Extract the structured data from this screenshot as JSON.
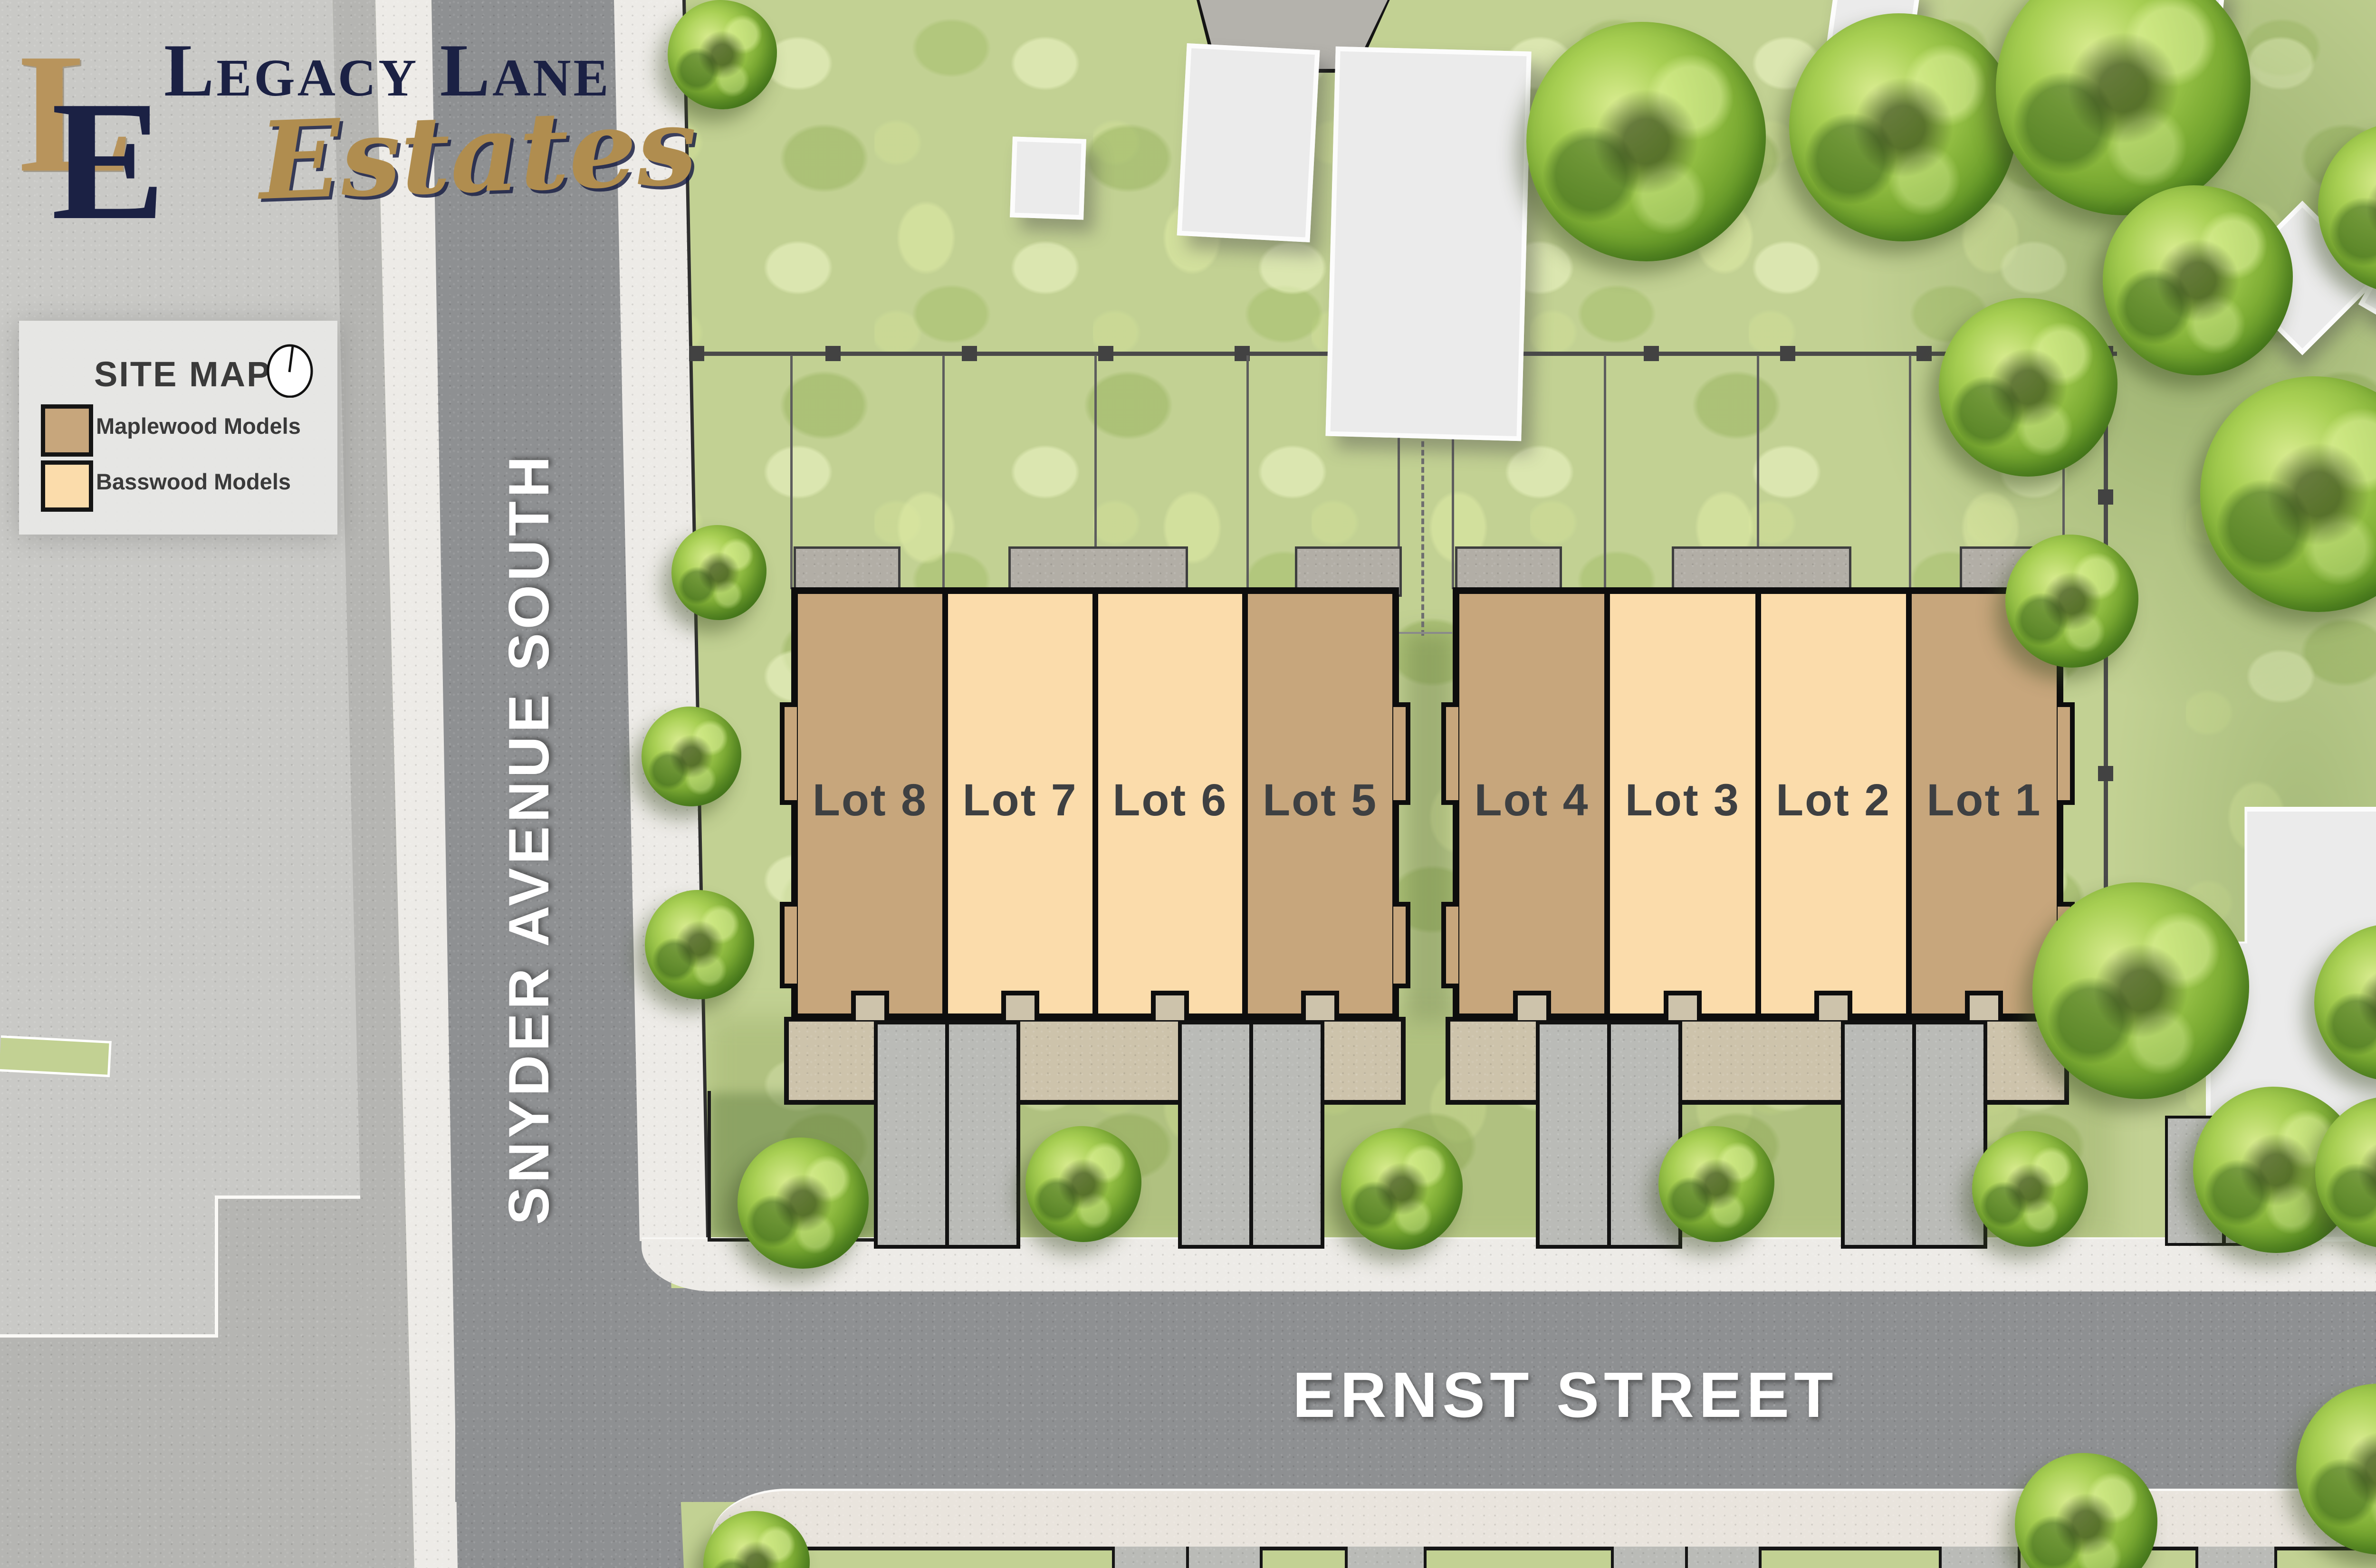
{
  "logo": {
    "monogram": [
      "L",
      "E"
    ],
    "title": "Legacy Lane",
    "subtitle": "Estates"
  },
  "legend": {
    "title": "SITE MAP",
    "compass_icon": "north-compass",
    "items": [
      {
        "label": "Maplewood Models",
        "color": "#c7a67c"
      },
      {
        "label": "Basswood Models",
        "color": "#fbdcab"
      }
    ]
  },
  "streets": {
    "north_south": "SNYDER AVENUE SOUTH",
    "east_west": "ERNST STREET"
  },
  "lots": [
    {
      "label": "Lot 8",
      "model": "Maplewood"
    },
    {
      "label": "Lot 7",
      "model": "Basswood"
    },
    {
      "label": "Lot 6",
      "model": "Basswood"
    },
    {
      "label": "Lot 5",
      "model": "Maplewood"
    },
    {
      "label": "Lot 4",
      "model": "Maplewood"
    },
    {
      "label": "Lot 3",
      "model": "Basswood"
    },
    {
      "label": "Lot 2",
      "model": "Basswood"
    },
    {
      "label": "Lot 1",
      "model": "Maplewood"
    }
  ],
  "colors": {
    "maplewood": "#c7a67c",
    "basswood": "#fbdcab",
    "navy": "#1b2144",
    "gold": "#b08d4f",
    "road": "#8e9092",
    "grass": "#c2d193"
  }
}
